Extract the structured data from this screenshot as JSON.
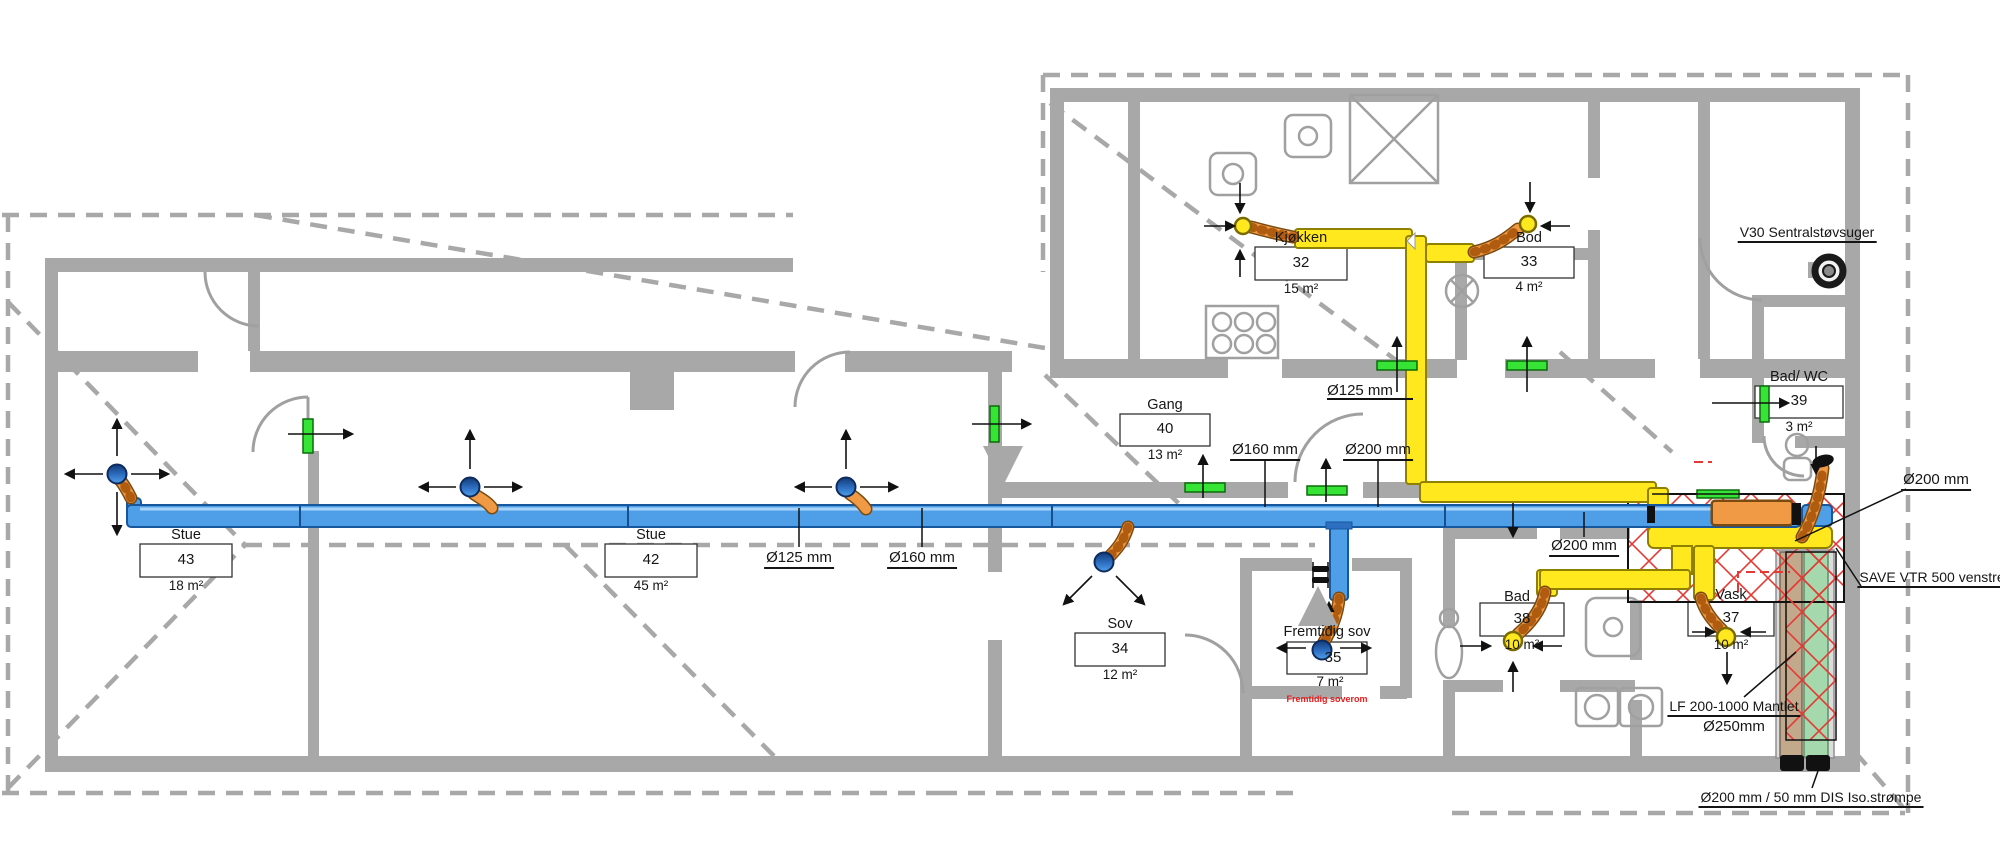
{
  "drawing_type": "ventilation-floor-plan",
  "colors": {
    "wall_gray": "#a8a8a8",
    "supply_duct_blue": "#4f9fe8",
    "extract_duct_yellow": "#ffe81e",
    "flex_duct_orange": "#f09a45",
    "valve_green": "#35e435",
    "hatch_red": "#e53935",
    "note_red": "#e81c1c",
    "pipe_tan": "#c2a98c",
    "pipe_green": "#a5d8ac"
  },
  "rooms": [
    {
      "name": "Stue",
      "number": "43",
      "area": "18 m²"
    },
    {
      "name": "Stue",
      "number": "42",
      "area": "45 m²"
    },
    {
      "name": "Gang",
      "number": "40",
      "area": "13 m²"
    },
    {
      "name": "Kjøkken",
      "number": "32",
      "area": "15 m²"
    },
    {
      "name": "Bod",
      "number": "33",
      "area": "4 m²"
    },
    {
      "name": "Bad/ WC",
      "number": "39",
      "area": "3 m²"
    },
    {
      "name": "Sov",
      "number": "34",
      "area": "12 m²"
    },
    {
      "name": "Fremtidig sov",
      "number": "35",
      "area": "7 m²",
      "note": "Fremtidig soverom"
    },
    {
      "name": "Bad",
      "number": "38",
      "area": "10 m²"
    },
    {
      "name": "Vask",
      "number": "37",
      "area": "10 m²"
    }
  ],
  "duct_labels": {
    "supply_125": "Ø125 mm",
    "supply_160": "Ø160 mm",
    "gang_160": "Ø160 mm",
    "gang_200": "Ø200 mm",
    "kitchen_125": "Ø125 mm",
    "main_200": "Ø200 mm",
    "outdoor_200": "Ø200 mm"
  },
  "annotations": {
    "central_vacuum": "V30 Sentralstøvsuger",
    "ahu": "SAVE VTR 500 venstre",
    "silencer_line1": "LF 200-1000 Mantlet",
    "silencer_line2": "Ø250mm",
    "riser": "Ø200 mm  / 50 mm  DIS Iso.strømpe"
  }
}
